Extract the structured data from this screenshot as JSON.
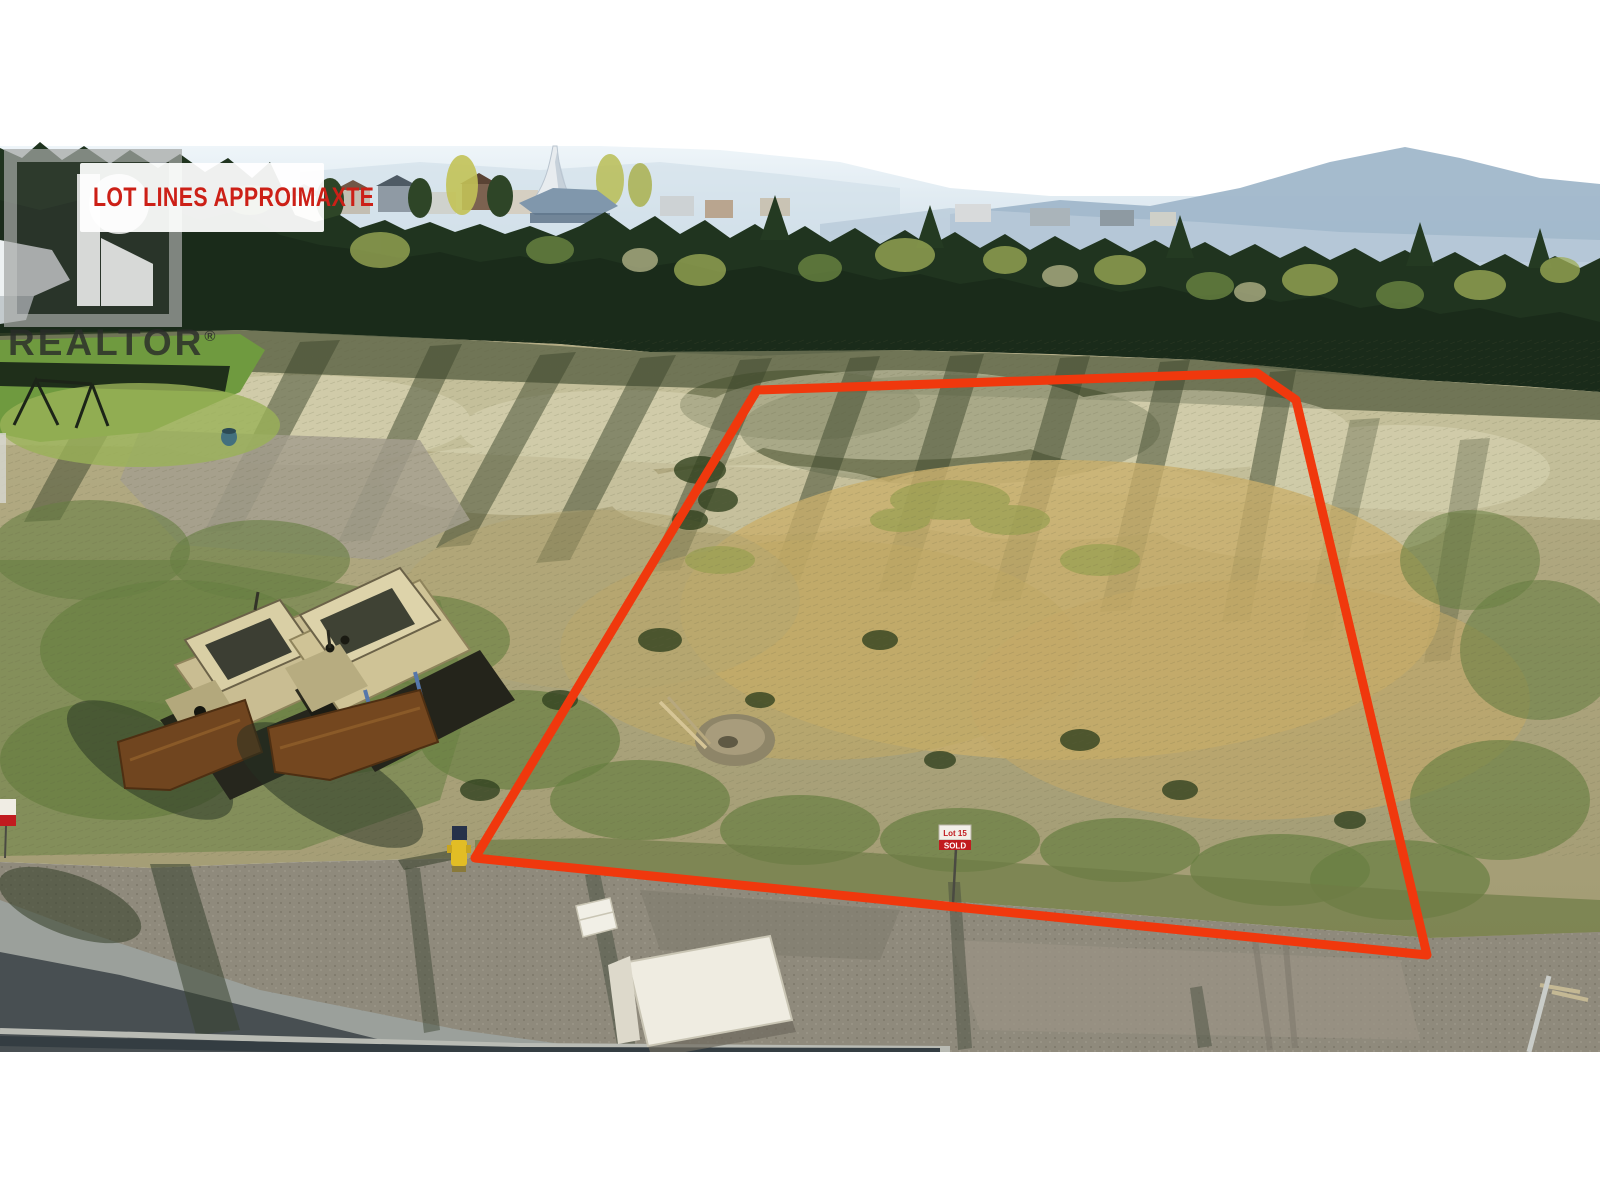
{
  "watermark": {
    "banner_text": "LOT LINES APPROIMAXTE",
    "banner_text_color": "#cc2017",
    "banner_bg": "#ffffff",
    "realtor_label": "REALTOR",
    "registered_symbol": "®",
    "logo": "realtor-r-logo"
  },
  "lot_outline": {
    "color": "#f0380d",
    "stroke_width": "9",
    "points": "475,858 757,390 1257,373 1296,400 1427,955"
  },
  "signs": {
    "lot_sign": {
      "line1": "Lot 15",
      "line2": "SOLD",
      "band_color": "#c11b1f"
    }
  },
  "scene": {
    "colors": {
      "sky_haze": "#dfeaf2",
      "mountain": "#a0b7ca",
      "forest_dark": "#1a2b1a",
      "field_gold": "#c9af6c",
      "field_silver": "#dcd8b8",
      "gravel": "#8f8a7c",
      "road_shadow": "#394145",
      "hydrant_yellow": "#e2bd25",
      "dozer_tan": "#cfc396",
      "blade_brown": "#74471f",
      "panel_white": "#efece1"
    }
  }
}
